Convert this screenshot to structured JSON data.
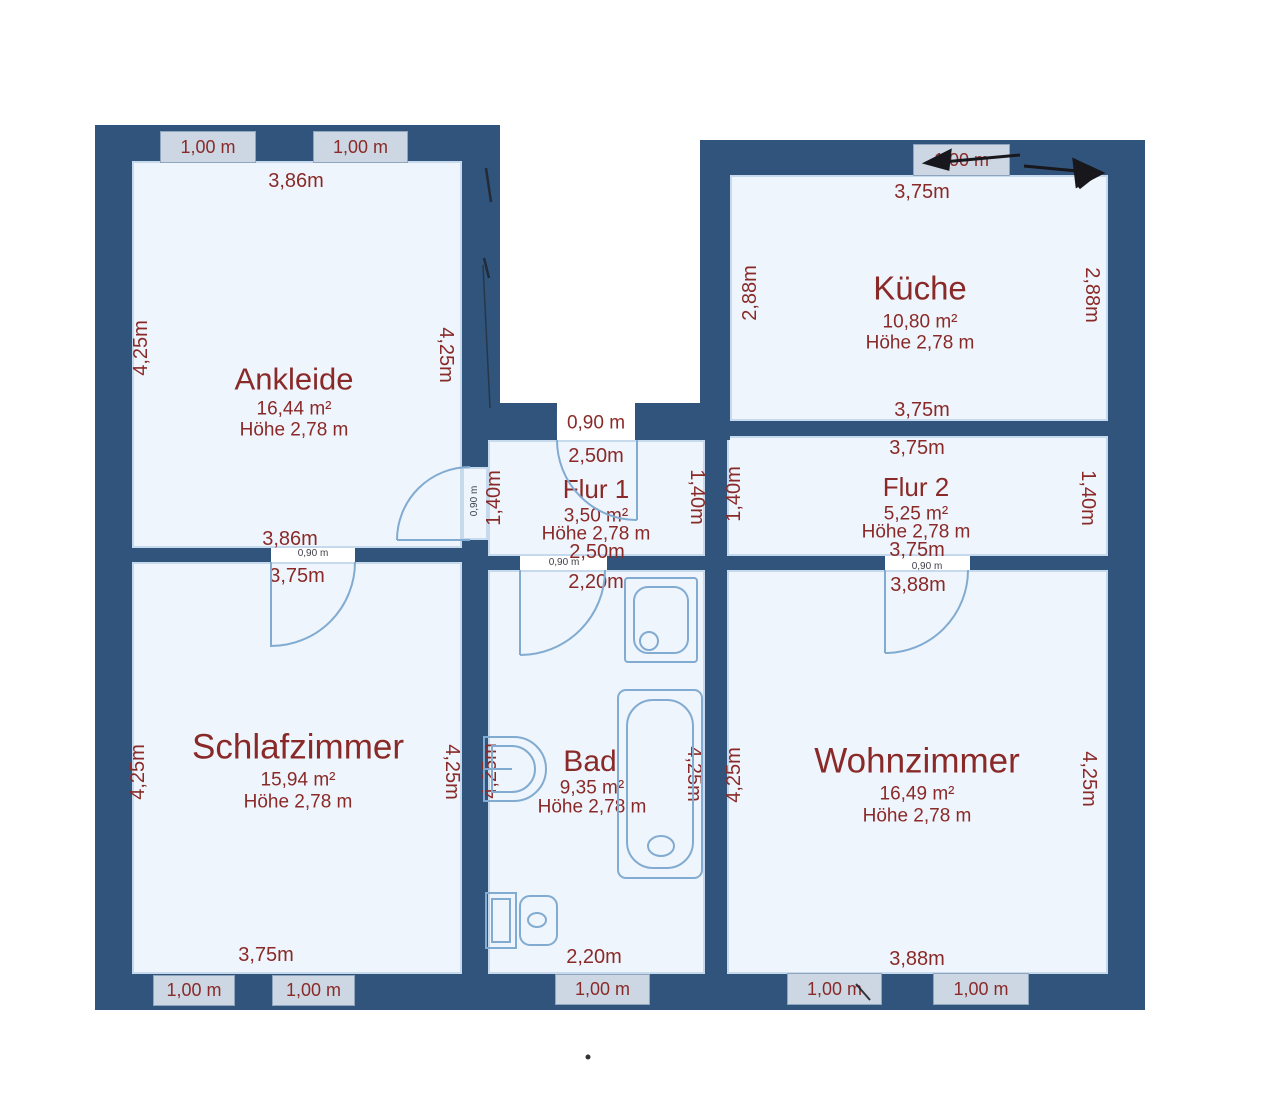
{
  "rooms": {
    "ankleide": {
      "name": "Ankleide",
      "area": "16,44 m²",
      "height": "Höhe 2,78 m",
      "dim_top": "3,86m",
      "dim_bottom": "3,86m",
      "dim_left": "4,25m",
      "dim_right": "4,25m"
    },
    "kueche": {
      "name": "Küche",
      "area": "10,80 m²",
      "height": "Höhe 2,78 m",
      "dim_top": "3,75m",
      "dim_bottom": "3,75m",
      "dim_left": "2,88m",
      "dim_right": "2,88m"
    },
    "flur1": {
      "name": "Flur 1",
      "area": "3,50 m²",
      "height": "Höhe 2,78 m",
      "dim_top": "2,50m",
      "dim_bottom": "2,50m",
      "dim_left": "1,40m",
      "dim_right": "1,40m",
      "door_top": "0,90 m",
      "door_left": "0,90 m"
    },
    "flur2": {
      "name": "Flur 2",
      "area": "5,25 m²",
      "height": "Höhe 2,78 m",
      "dim_top": "3,75m",
      "dim_bottom": "3,75m",
      "dim_left": "1,40m",
      "dim_right": "1,40m"
    },
    "schlafzimmer": {
      "name": "Schlafzimmer",
      "area": "15,94 m²",
      "height": "Höhe 2,78 m",
      "dim_top": "3,75m",
      "dim_bottom": "3,75m",
      "dim_left": "4,25m",
      "dim_right": "4,25m",
      "door_top": "0,90 m"
    },
    "bad": {
      "name": "Bad",
      "area": "9,35 m²",
      "height": "Höhe 2,78 m",
      "dim_top": "2,20m",
      "dim_bottom": "2,20m",
      "dim_left": "4,25m",
      "dim_right": "4,25m",
      "door_top": "0,90 m"
    },
    "wohnzimmer": {
      "name": "Wohnzimmer",
      "area": "16,49 m²",
      "height": "Höhe 2,78 m",
      "dim_top": "3,88m",
      "dim_bottom": "3,88m",
      "dim_left": "4,25m",
      "dim_right": "4,25m",
      "door_top": "0,90 m"
    }
  },
  "windows": {
    "label": "1,00 m"
  },
  "colors": {
    "wall": "#31547c",
    "floor": "#eef5fc",
    "dimension_text": "#8a2a28",
    "window_fill": "#ccd7e3",
    "fixture_line": "#82abd1",
    "pen_ink": "#17171c"
  }
}
